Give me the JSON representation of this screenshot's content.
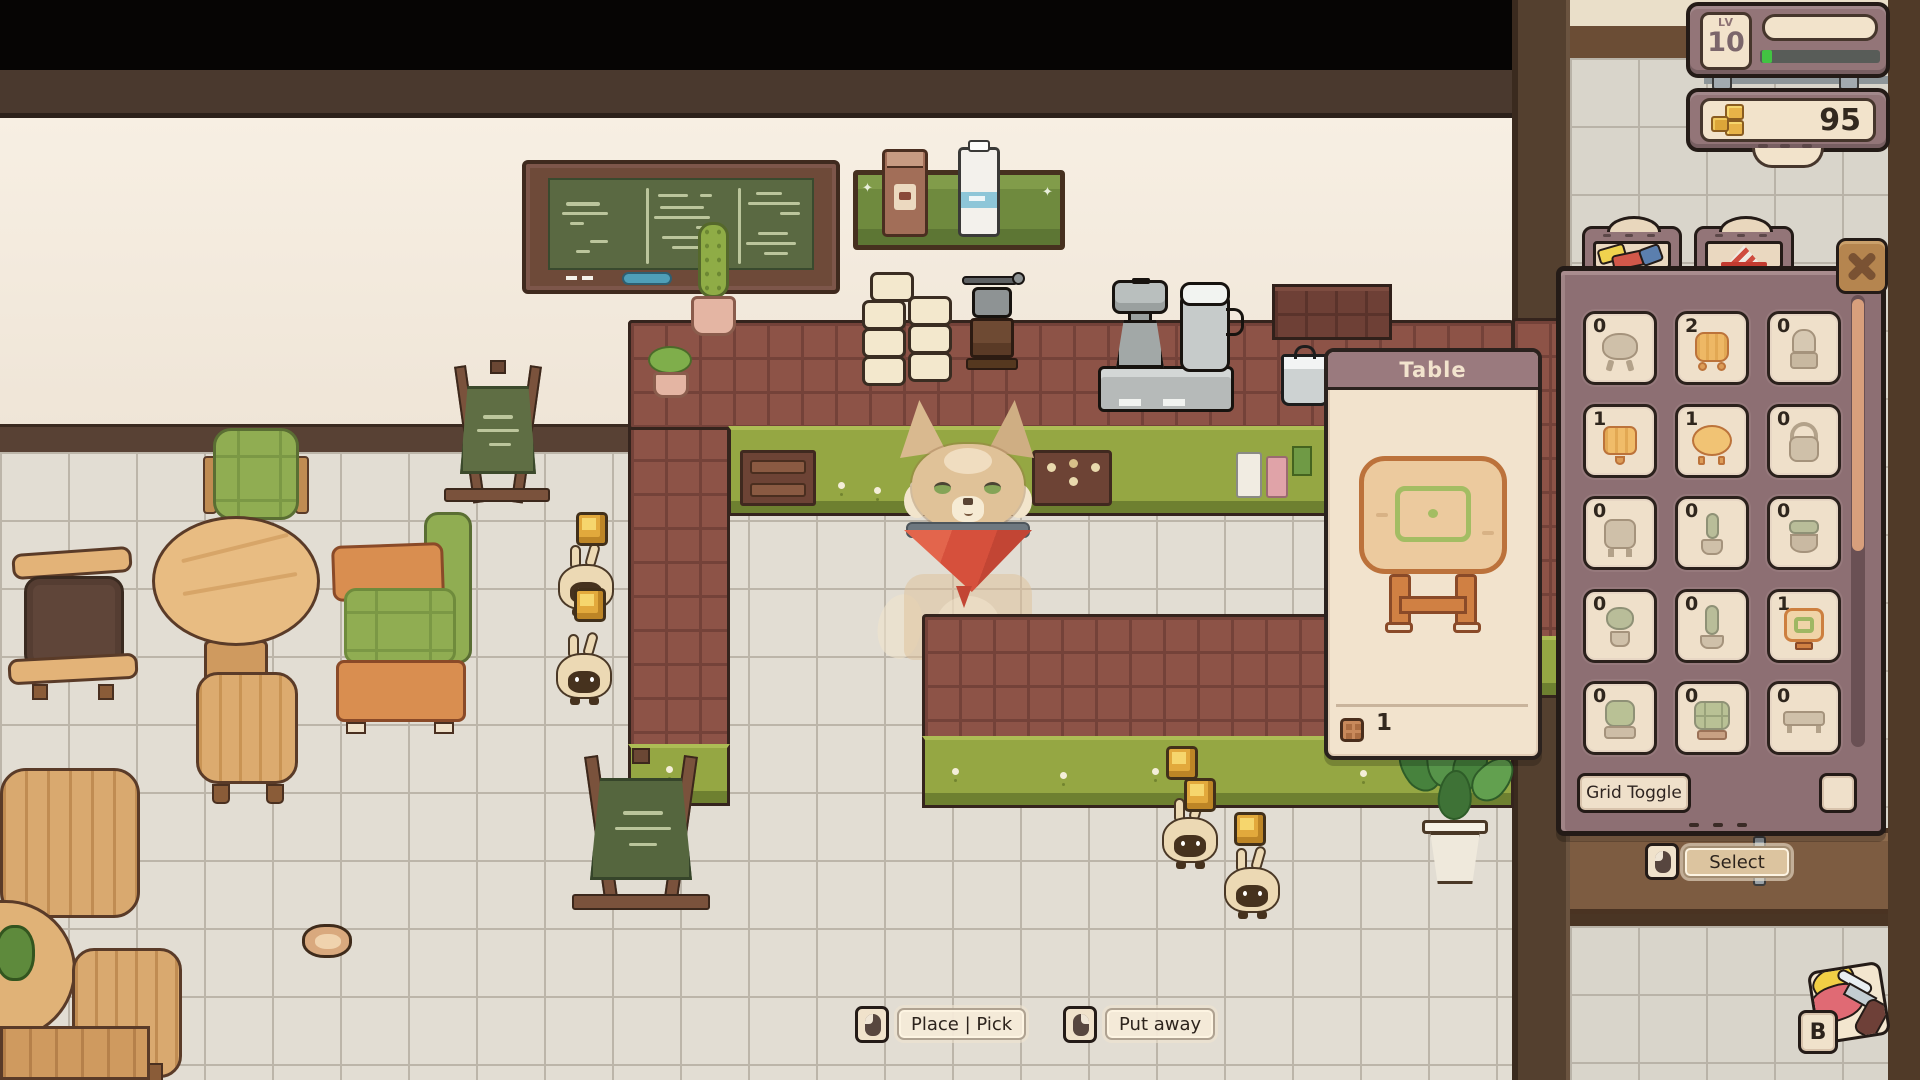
{
  "hud": {
    "level": {
      "label": "LV",
      "value": "10",
      "xp_fill_ratio": 0.07
    },
    "money": {
      "value": "95",
      "icon": "coin-stack-icon"
    }
  },
  "build_panel": {
    "tabs": [
      {
        "name": "furniture",
        "icon": "bed-icon"
      },
      {
        "name": "signs",
        "icon": "a-frame-sign-icon"
      }
    ],
    "close_icon": "x-icon",
    "slots": [
      {
        "count": "0",
        "item": "stool",
        "owned": false
      },
      {
        "count": "2",
        "item": "wood-stool",
        "owned": true
      },
      {
        "count": "0",
        "item": "high-chair",
        "owned": false
      },
      {
        "count": "1",
        "item": "square-table",
        "owned": true
      },
      {
        "count": "1",
        "item": "round-table",
        "owned": true
      },
      {
        "count": "0",
        "item": "arm-chair",
        "owned": false
      },
      {
        "count": "0",
        "item": "side-table",
        "owned": false
      },
      {
        "count": "0",
        "item": "potted-cactus",
        "owned": false
      },
      {
        "count": "0",
        "item": "planter",
        "owned": false
      },
      {
        "count": "0",
        "item": "potted-plant",
        "owned": false
      },
      {
        "count": "0",
        "item": "tall-cactus",
        "owned": false
      },
      {
        "count": "1",
        "item": "table",
        "owned": true,
        "selected": true
      },
      {
        "count": "0",
        "item": "cushion-chair",
        "owned": false
      },
      {
        "count": "0",
        "item": "sofa",
        "owned": false
      },
      {
        "count": "0",
        "item": "long-table",
        "owned": false
      }
    ],
    "grid_toggle_label": "Grid Toggle",
    "grid_checkbox_checked": false
  },
  "item_popup": {
    "title": "Table",
    "count": "1",
    "count_icon": "crate-icon"
  },
  "prompts": {
    "select": {
      "label": "Select",
      "icon": "mouse-left-icon"
    },
    "place_pick": {
      "label": "Place | Pick",
      "icon": "mouse-left-icon"
    },
    "put_away": {
      "label": "Put away",
      "icon": "mouse-right-icon"
    },
    "brush": {
      "key": "B",
      "icon": "paint-brush-icon"
    }
  },
  "scene": {
    "characters": [
      "fox-barista",
      "bunny-customer"
    ],
    "colors": {
      "panel_mauve": "#937578",
      "ui_cream": "#f2e3cb",
      "counter_brick": "#8d5347",
      "counter_green": "#95a743",
      "coin_gold": "#e2a93c",
      "chalkboard_green": "#5a6942"
    }
  }
}
